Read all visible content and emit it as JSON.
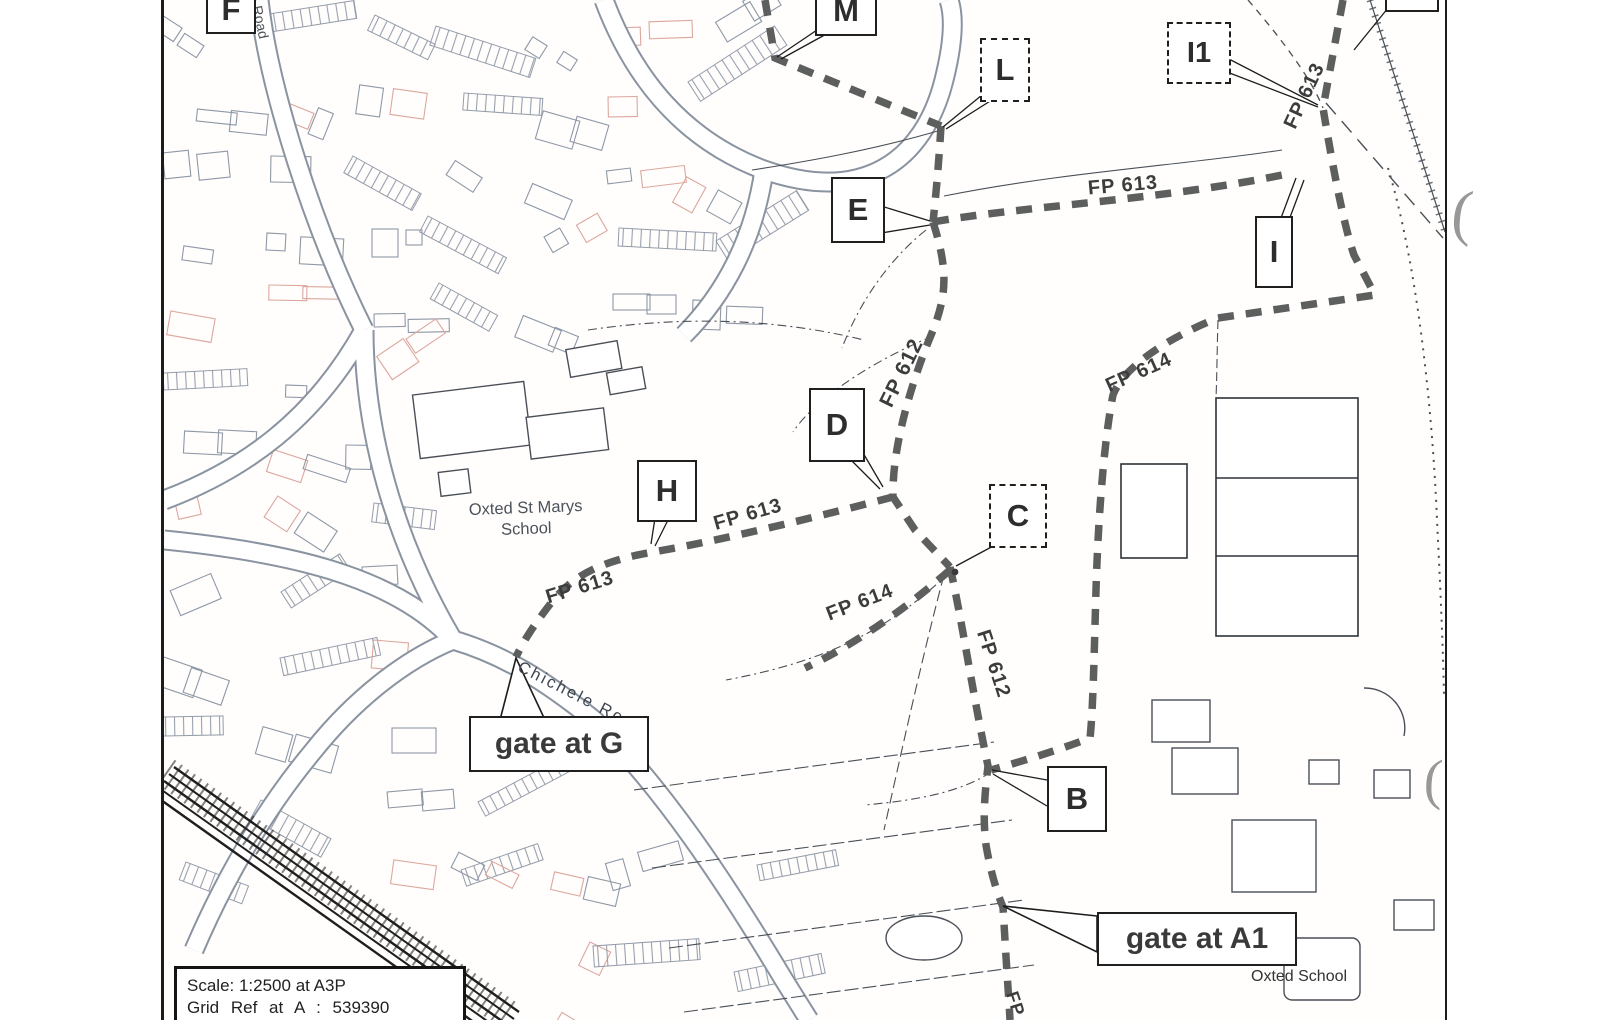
{
  "map": {
    "markers": {
      "f": "F",
      "m": "M",
      "l": "L",
      "i1": "I1",
      "i": "I",
      "e": "E",
      "d": "D",
      "h": "H",
      "c": "C",
      "b": "B"
    },
    "callouts": {
      "gate_g": "gate at G",
      "gate_a1": "gate at A1"
    },
    "footpath_labels": {
      "fp612": "FP 612",
      "fp613": "FP 613",
      "fp614": "FP 614",
      "fp_partial": "FP"
    },
    "places": {
      "st_marys_line1": "Oxted St Marys",
      "st_marys_line2": "School",
      "oxted_school": "Oxted School",
      "chichele_road": "Chichele Road",
      "road_partial": "Road"
    },
    "scale_box": {
      "line1": "Scale: 1:2500 at A3P",
      "line2": "Grid  Ref  at  A  :  539390"
    },
    "colors": {
      "footpath_dash": "#5d5f5e",
      "map_ink": "#3e4450",
      "building_tint": "#dca79e"
    }
  }
}
